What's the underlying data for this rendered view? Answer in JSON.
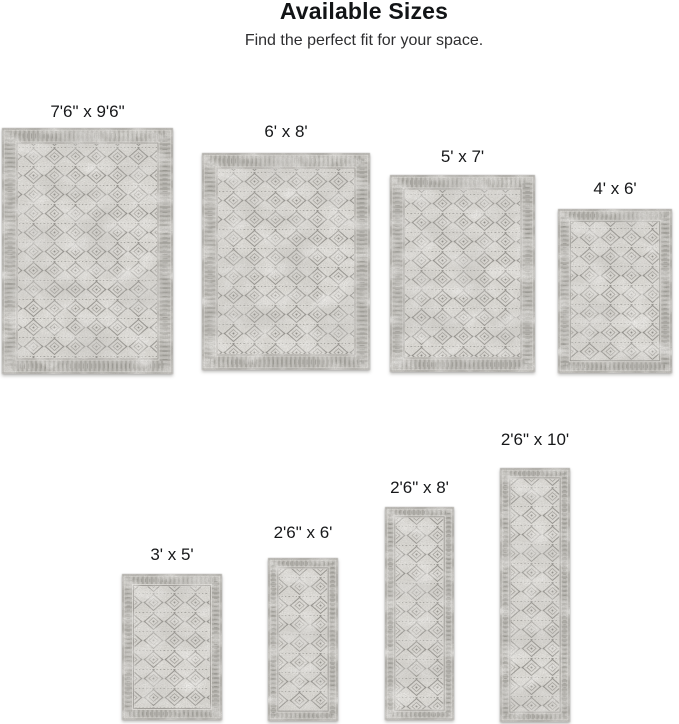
{
  "header": {
    "title": "Available Sizes",
    "subtitle": "Find the perfect fit for your space."
  },
  "sizes": [
    {
      "id": "7-6x9-6",
      "label": "7'6\" x 9'6\""
    },
    {
      "id": "6x8",
      "label": "6' x 8'"
    },
    {
      "id": "5x7",
      "label": "5' x 7'"
    },
    {
      "id": "4x6",
      "label": "4' x 6'"
    },
    {
      "id": "3x5",
      "label": "3' x 5'"
    },
    {
      "id": "2-6x6",
      "label": "2'6\" x 6'"
    },
    {
      "id": "2-6x8",
      "label": "2'6\" x 8'"
    },
    {
      "id": "2-6x10",
      "label": "2'6\" x 10'"
    }
  ],
  "colors": {
    "background": "#ffffff",
    "text": "#17181a",
    "rug_base": "#e3e1dc",
    "rug_border": "#8f8d88",
    "rug_pattern": "#8a8883"
  }
}
